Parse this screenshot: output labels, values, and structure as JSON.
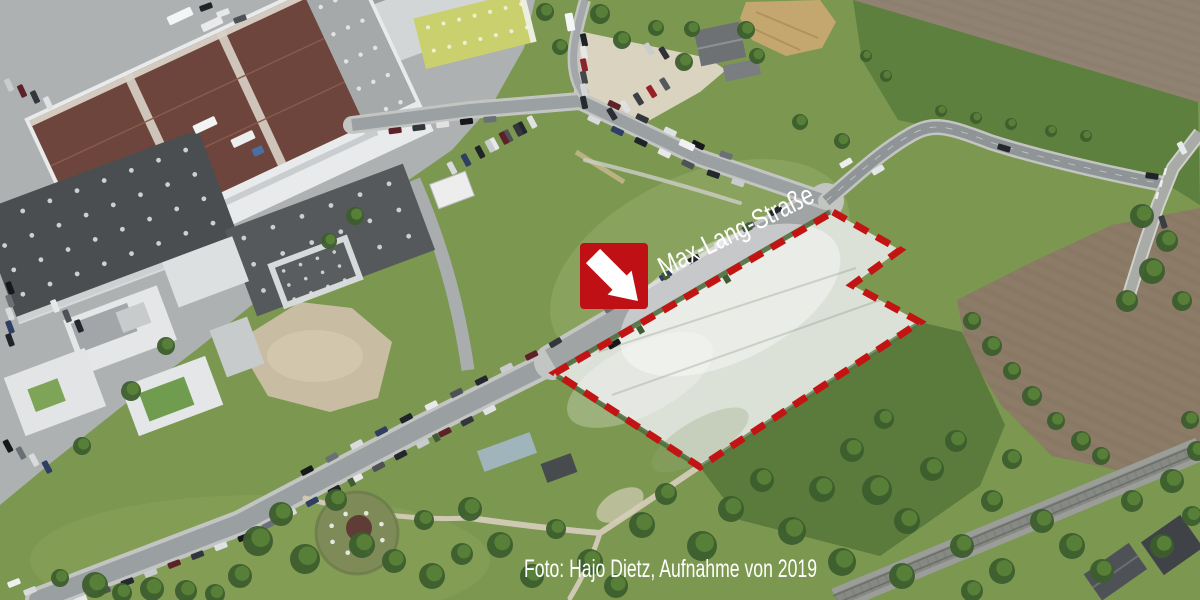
{
  "labels": {
    "street": "Max-Lang-Straße",
    "photo_credit": "Foto: Hajo Dietz, Aufnahme von 2019"
  },
  "marker": {
    "icon": "arrow-down-right-icon",
    "color": "#bf1015",
    "x": 580,
    "y": 243,
    "size": 68
  },
  "site_outline": {
    "color": "#c31414",
    "style": "dashed",
    "vertices": [
      [
        833,
        212
      ],
      [
        900,
        250
      ],
      [
        852,
        285
      ],
      [
        920,
        322
      ],
      [
        700,
        467
      ],
      [
        555,
        373
      ]
    ]
  },
  "palette": {
    "grass": "#7b9750",
    "grass_dark": "#5e803e",
    "field_brown": "#8f8272",
    "field_brown_2": "#8b7b67",
    "road": "#9aa0a2",
    "road_casing": "#c3c5c2",
    "pavement": "#aeb1b2",
    "plot_fill": "#dce1d8",
    "railway": "#9a9d98",
    "tree": "#3c5e2d",
    "dash_red": "#c31414",
    "marker_red": "#bf1015",
    "text_white": "#ffffff"
  }
}
